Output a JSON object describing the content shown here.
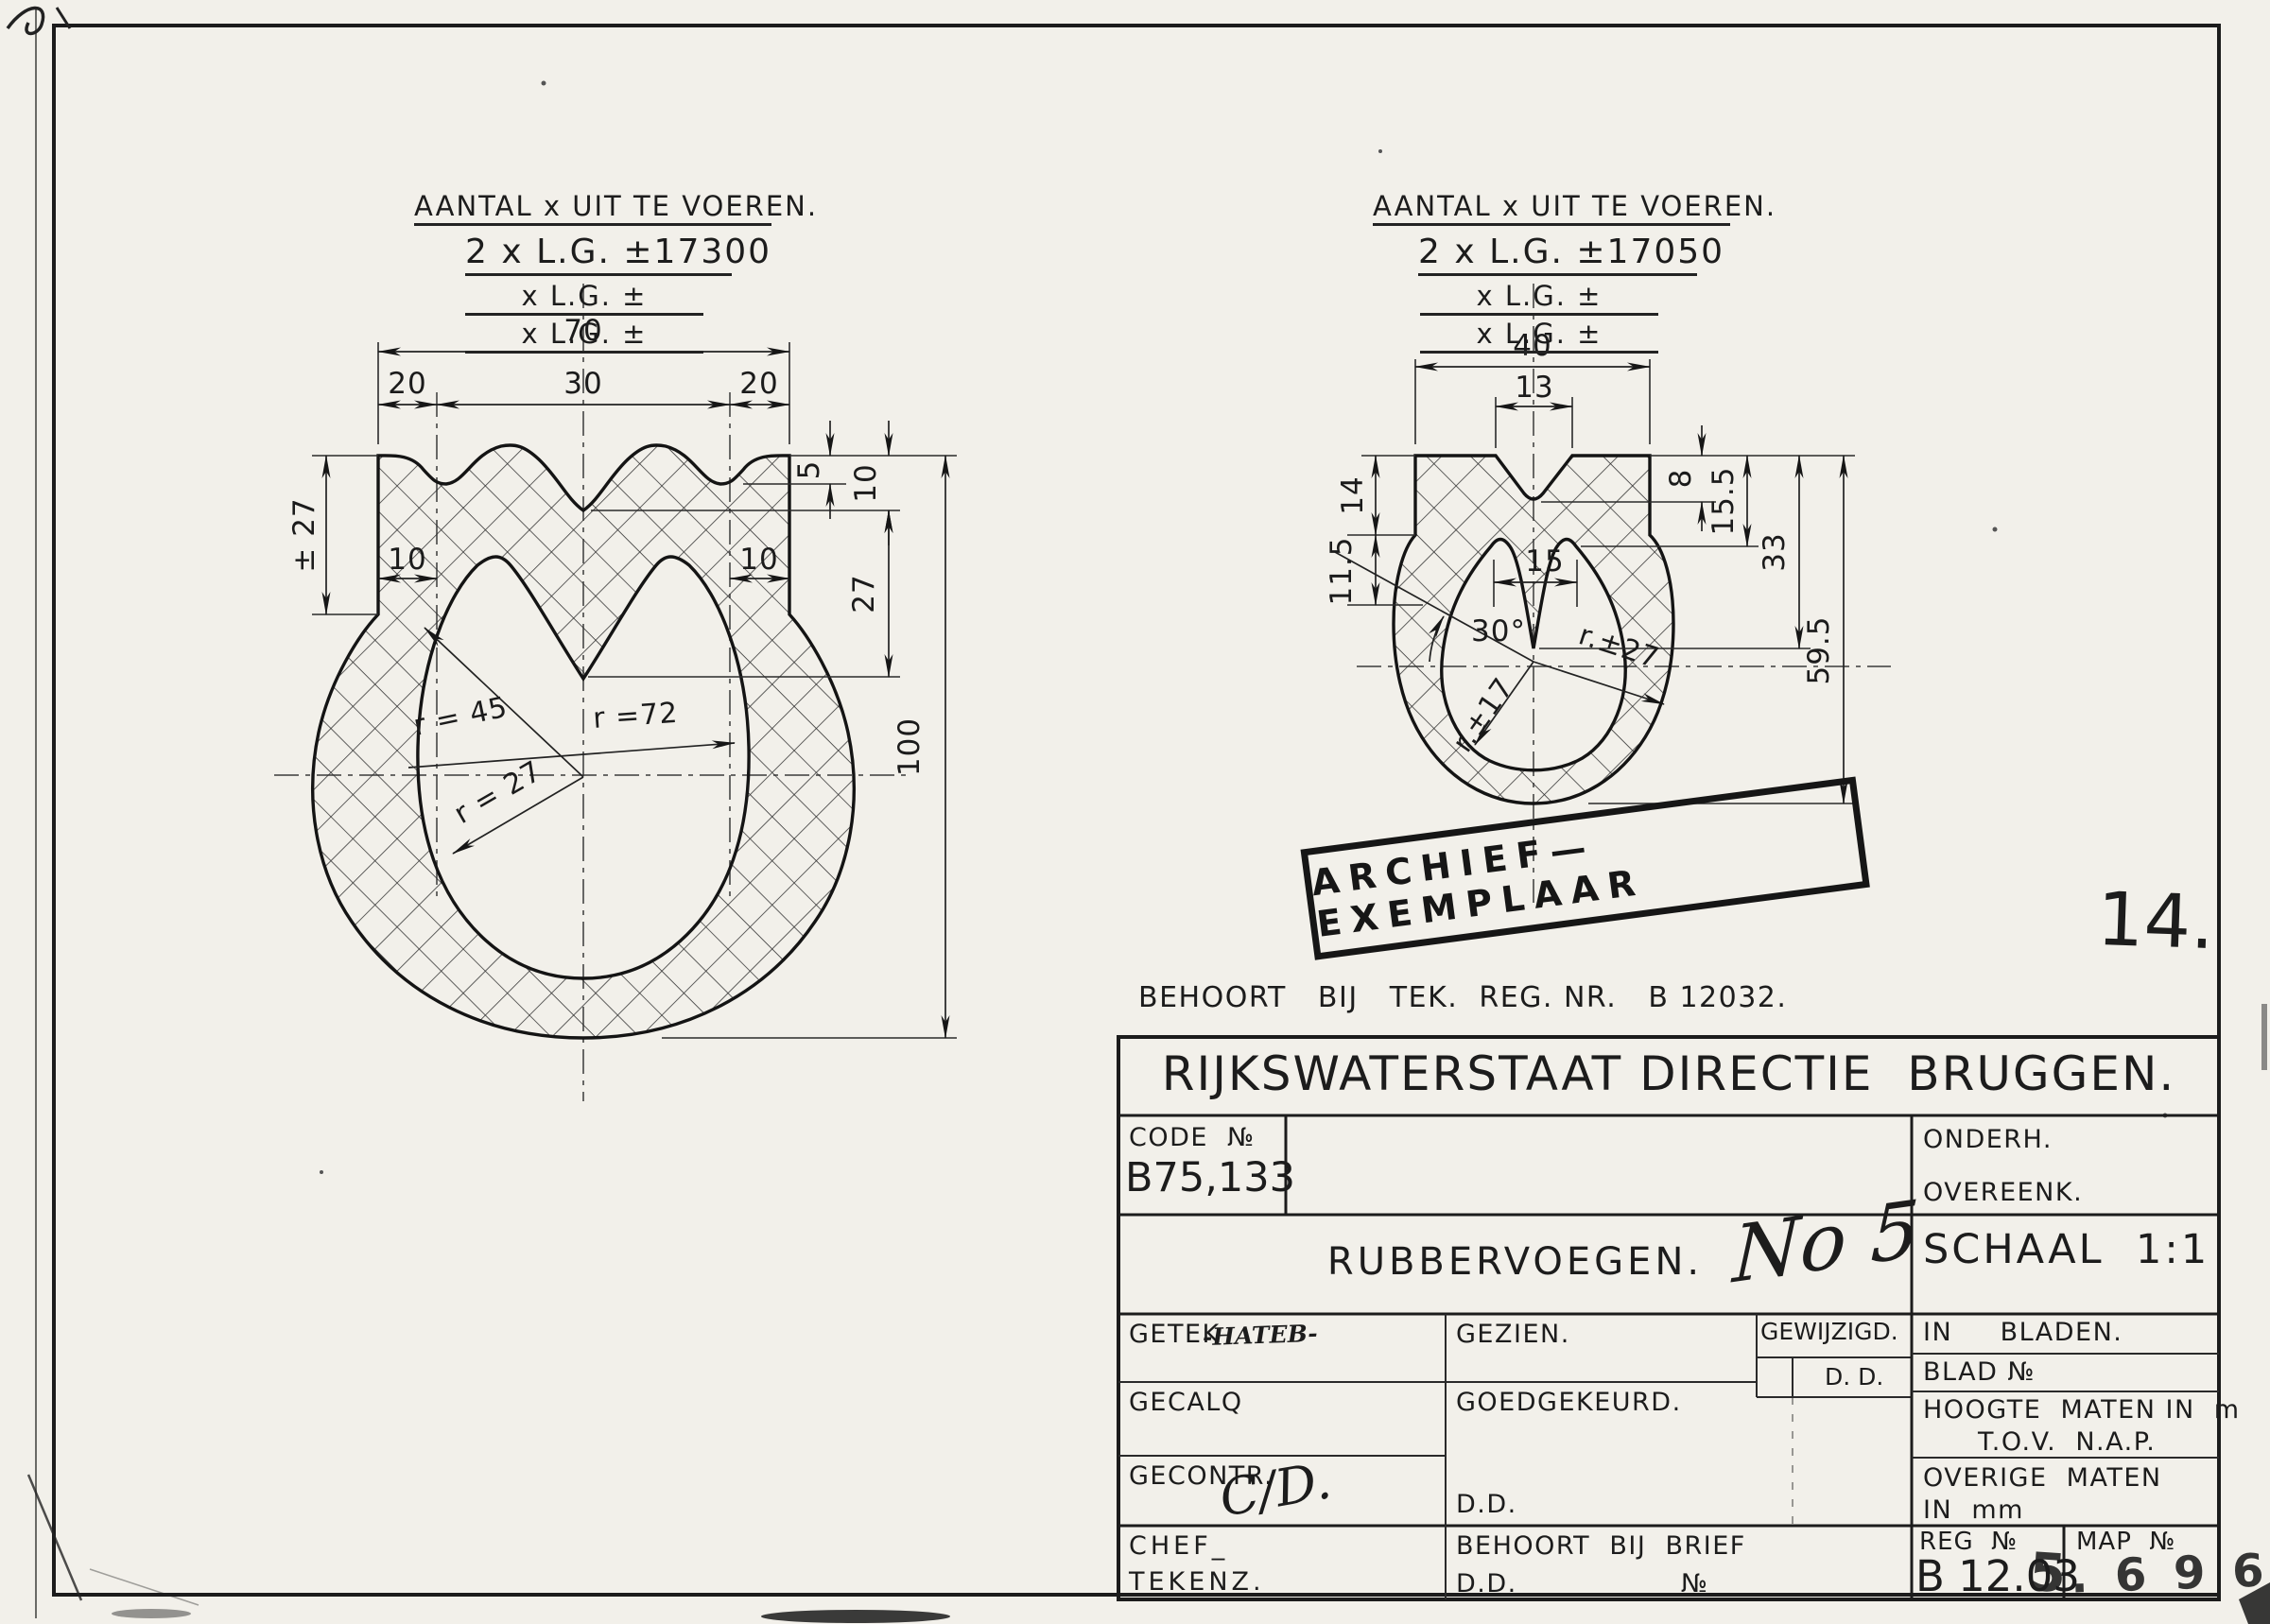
{
  "sheet": {
    "page_number": "14.",
    "belongs_note": "BEHOORT   BIJ   TEK.  REG. NR.   B 12032.",
    "stamp": "ARCHIEF—EXEMPLAAR"
  },
  "left_figure": {
    "header_title": "AANTAL x UIT TE VOEREN.",
    "qty_line": "2 x L.G. ±17300",
    "blank_line1": "x L.G. ±",
    "blank_line2": "x L.G. ±",
    "dim_70": "70",
    "dim_20a": "20",
    "dim_30": "30",
    "dim_20b": "20",
    "dim_pm27": "± 27",
    "dim_10_left": "10",
    "dim_10_right": "10",
    "dim_5": "5",
    "dim_10_side": "10",
    "dim_27": "27",
    "dim_100": "100",
    "radius_45": "r = 45",
    "radius_72": "r =72",
    "radius_27": "r = 27"
  },
  "right_figure": {
    "header_title": "AANTAL x UIT TE VOEREN.",
    "qty_line": "2 x L.G. ±17050",
    "blank_line1": "x L.G. ±",
    "blank_line2": "x L.G. ±",
    "dim_40": "40",
    "dim_13": "13",
    "dim_14": "14",
    "dim_11_5": "11.5",
    "dim_15": "15",
    "dim_8": "8",
    "dim_15_5": "15.5",
    "dim_33": "33",
    "dim_59_5": "59.5",
    "angle_30": "30°",
    "radius_17": "r.±17",
    "radius_27": "r.±27"
  },
  "title_block": {
    "org": "RIJKSWATERSTAAT DIRECTIE  BRUGGEN.",
    "code_label": "CODE  №",
    "code_value": "B75,133",
    "onderh": "ONDERH.",
    "overeenk": "OVEREENK.",
    "subject": "RUBBERVOEGEN.",
    "subject_handwritten": "No 5",
    "schaal": "SCHAAL  1:1",
    "getek_label": "GETEK",
    "getek_sig": "-HATEB-",
    "gezien_label": "GEZIEN.",
    "gewijzigd_label": "GEWIJZIGD.",
    "dd1": "D. D.",
    "in_bladen": "IN     BLADEN.",
    "blad_no": "BLAD №",
    "gecalq_label": "GECALQ",
    "goedgekeurd_label": "GOEDGEKEURD.",
    "hoogte_maten": "HOOGTE  MATEN IN  m",
    "tov_nap": "T.O.V.  N.A.P.",
    "gecontr_label": "GECONTR.",
    "gecontr_sig": "C/D.",
    "dd2": "D.D.",
    "overige_maten": "OVERIGE  MATEN",
    "in_mm": "IN  mm",
    "chef_line1": "CHEF_",
    "chef_line2": "TEKENZ.",
    "behoort_brief": "BEHOORT  BIJ  BRIEF",
    "dd3": "D.D.",
    "no3": "№",
    "reg_label": "REG  №",
    "reg_value": "B 12.03",
    "reg_stamp": "5",
    "map_label": "MAP  №",
    "map_value": ". 6 9 6"
  }
}
